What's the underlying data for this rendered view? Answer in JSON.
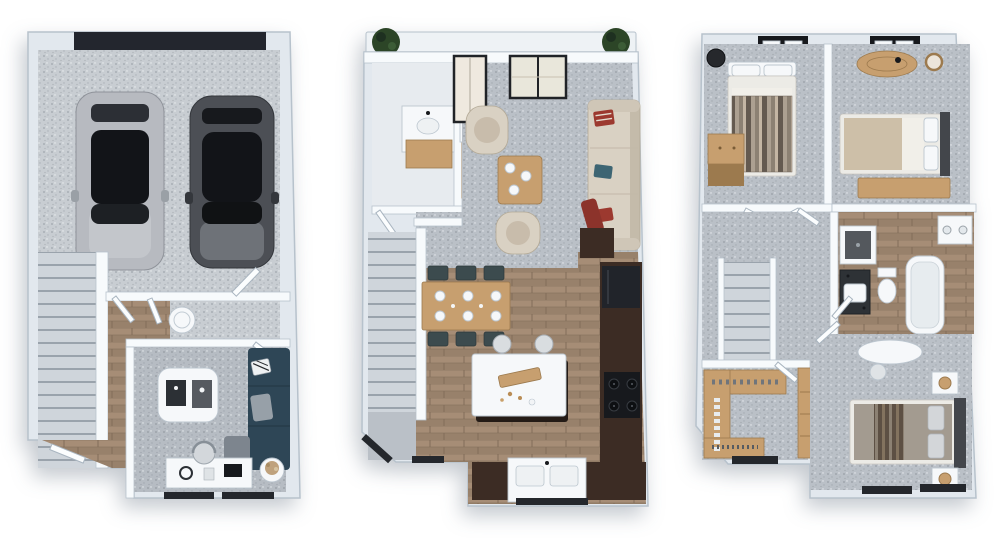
{
  "page": {
    "background": "#ffffff",
    "content": "three 3D isometric floor plan renders of a townhome, no visible text"
  },
  "palette": {
    "pageBg": "#ffffff",
    "wallBand": "#e2e8ee",
    "wallLine": "#b7c2cc",
    "wallWhite": "#f7fafc",
    "concrete": "#c8cdd2",
    "carpet": "#bac0c7",
    "carpetDen": "#b6bcc3",
    "treadFill": "#cfd5db",
    "treadGap": "#9aa3ac",
    "woodA": "#a68d76",
    "woodB": "#98816b",
    "woodJoint": "#826d59",
    "woodLight": "#c79f6f",
    "woodEdge": "#9c7a4e",
    "espresso": "#3c2c24",
    "applianceBlack": "#17191d",
    "windowBand": "#24272c",
    "garageDoor": "#23262e",
    "carSilver": "#b7bac0",
    "carCharcoal": "#4c4f55",
    "glassDark": "#121418",
    "navySofa": "#2e4656",
    "creamSofa": "#d9d1c3",
    "creamEdge": "#b3a996",
    "armchairSeat": "#c8bcab",
    "accentRed": "#9c392f",
    "tealAccent": "#3d6573",
    "slateChair": "#3c4b4e",
    "whiteObj": "#f6f8fa",
    "objStroke": "#bcc6cf",
    "plantGreen": "#2c4527",
    "plantDry": "#bfa27d",
    "tanBlanket": "#cdbfa8",
    "duvetDark": "#645a50",
    "duvetMid": "#8c8173",
    "duvetLight": "#aca091",
    "brownDark": "#5d5044",
    "brownMid": "#83735f"
  },
  "floorplans": [
    {
      "id": "garage-level",
      "position": "left",
      "rooms": [
        "two-car garage",
        "staircase",
        "entry hall",
        "utility corridor",
        "flex room"
      ],
      "furniture": [
        "garage door",
        "silver car",
        "charcoal car",
        "water heater",
        "navy sectional sofa",
        "white coffee table",
        "desk with chair",
        "plant side table",
        "angled entry door",
        "two windows"
      ]
    },
    {
      "id": "main-level",
      "position": "center",
      "rooms": [
        "balcony",
        "powder room",
        "living room",
        "dining area",
        "kitchen",
        "staircase"
      ],
      "furniture": [
        "two potted plants",
        "black framed balcony doors",
        "powder vanity",
        "bar counter",
        "cream sofa with red and teal pillows",
        "two cream armchairs",
        "wood coffee table",
        "dining table with six slate chairs",
        "white kitchen island with two stools",
        "espresso cabinets",
        "fridge",
        "range with four burners",
        "double basin sink",
        "windows"
      ]
    },
    {
      "id": "upper-level",
      "position": "right",
      "rooms": [
        "bedroom 2",
        "bedroom 3",
        "hall bathroom",
        "laundry nook",
        "hallway",
        "staircase",
        "walk-in closet",
        "primary bedroom"
      ],
      "furniture": [
        "two black skylight windows",
        "striped duvet bed",
        "black lounge chair",
        "two-tone wood dresser",
        "closet shelf",
        "oval wood console",
        "round wall mirror",
        "bed with wood bench",
        "washer",
        "shower",
        "dark vanity with sink",
        "toilet",
        "bathtub",
        "wood closet shelving with clothes",
        "wardrobe desk with lamp",
        "marble makeup vanity with stool",
        "primary bed with striped runner",
        "two nightstands with wood lamps",
        "windows"
      ]
    }
  ]
}
